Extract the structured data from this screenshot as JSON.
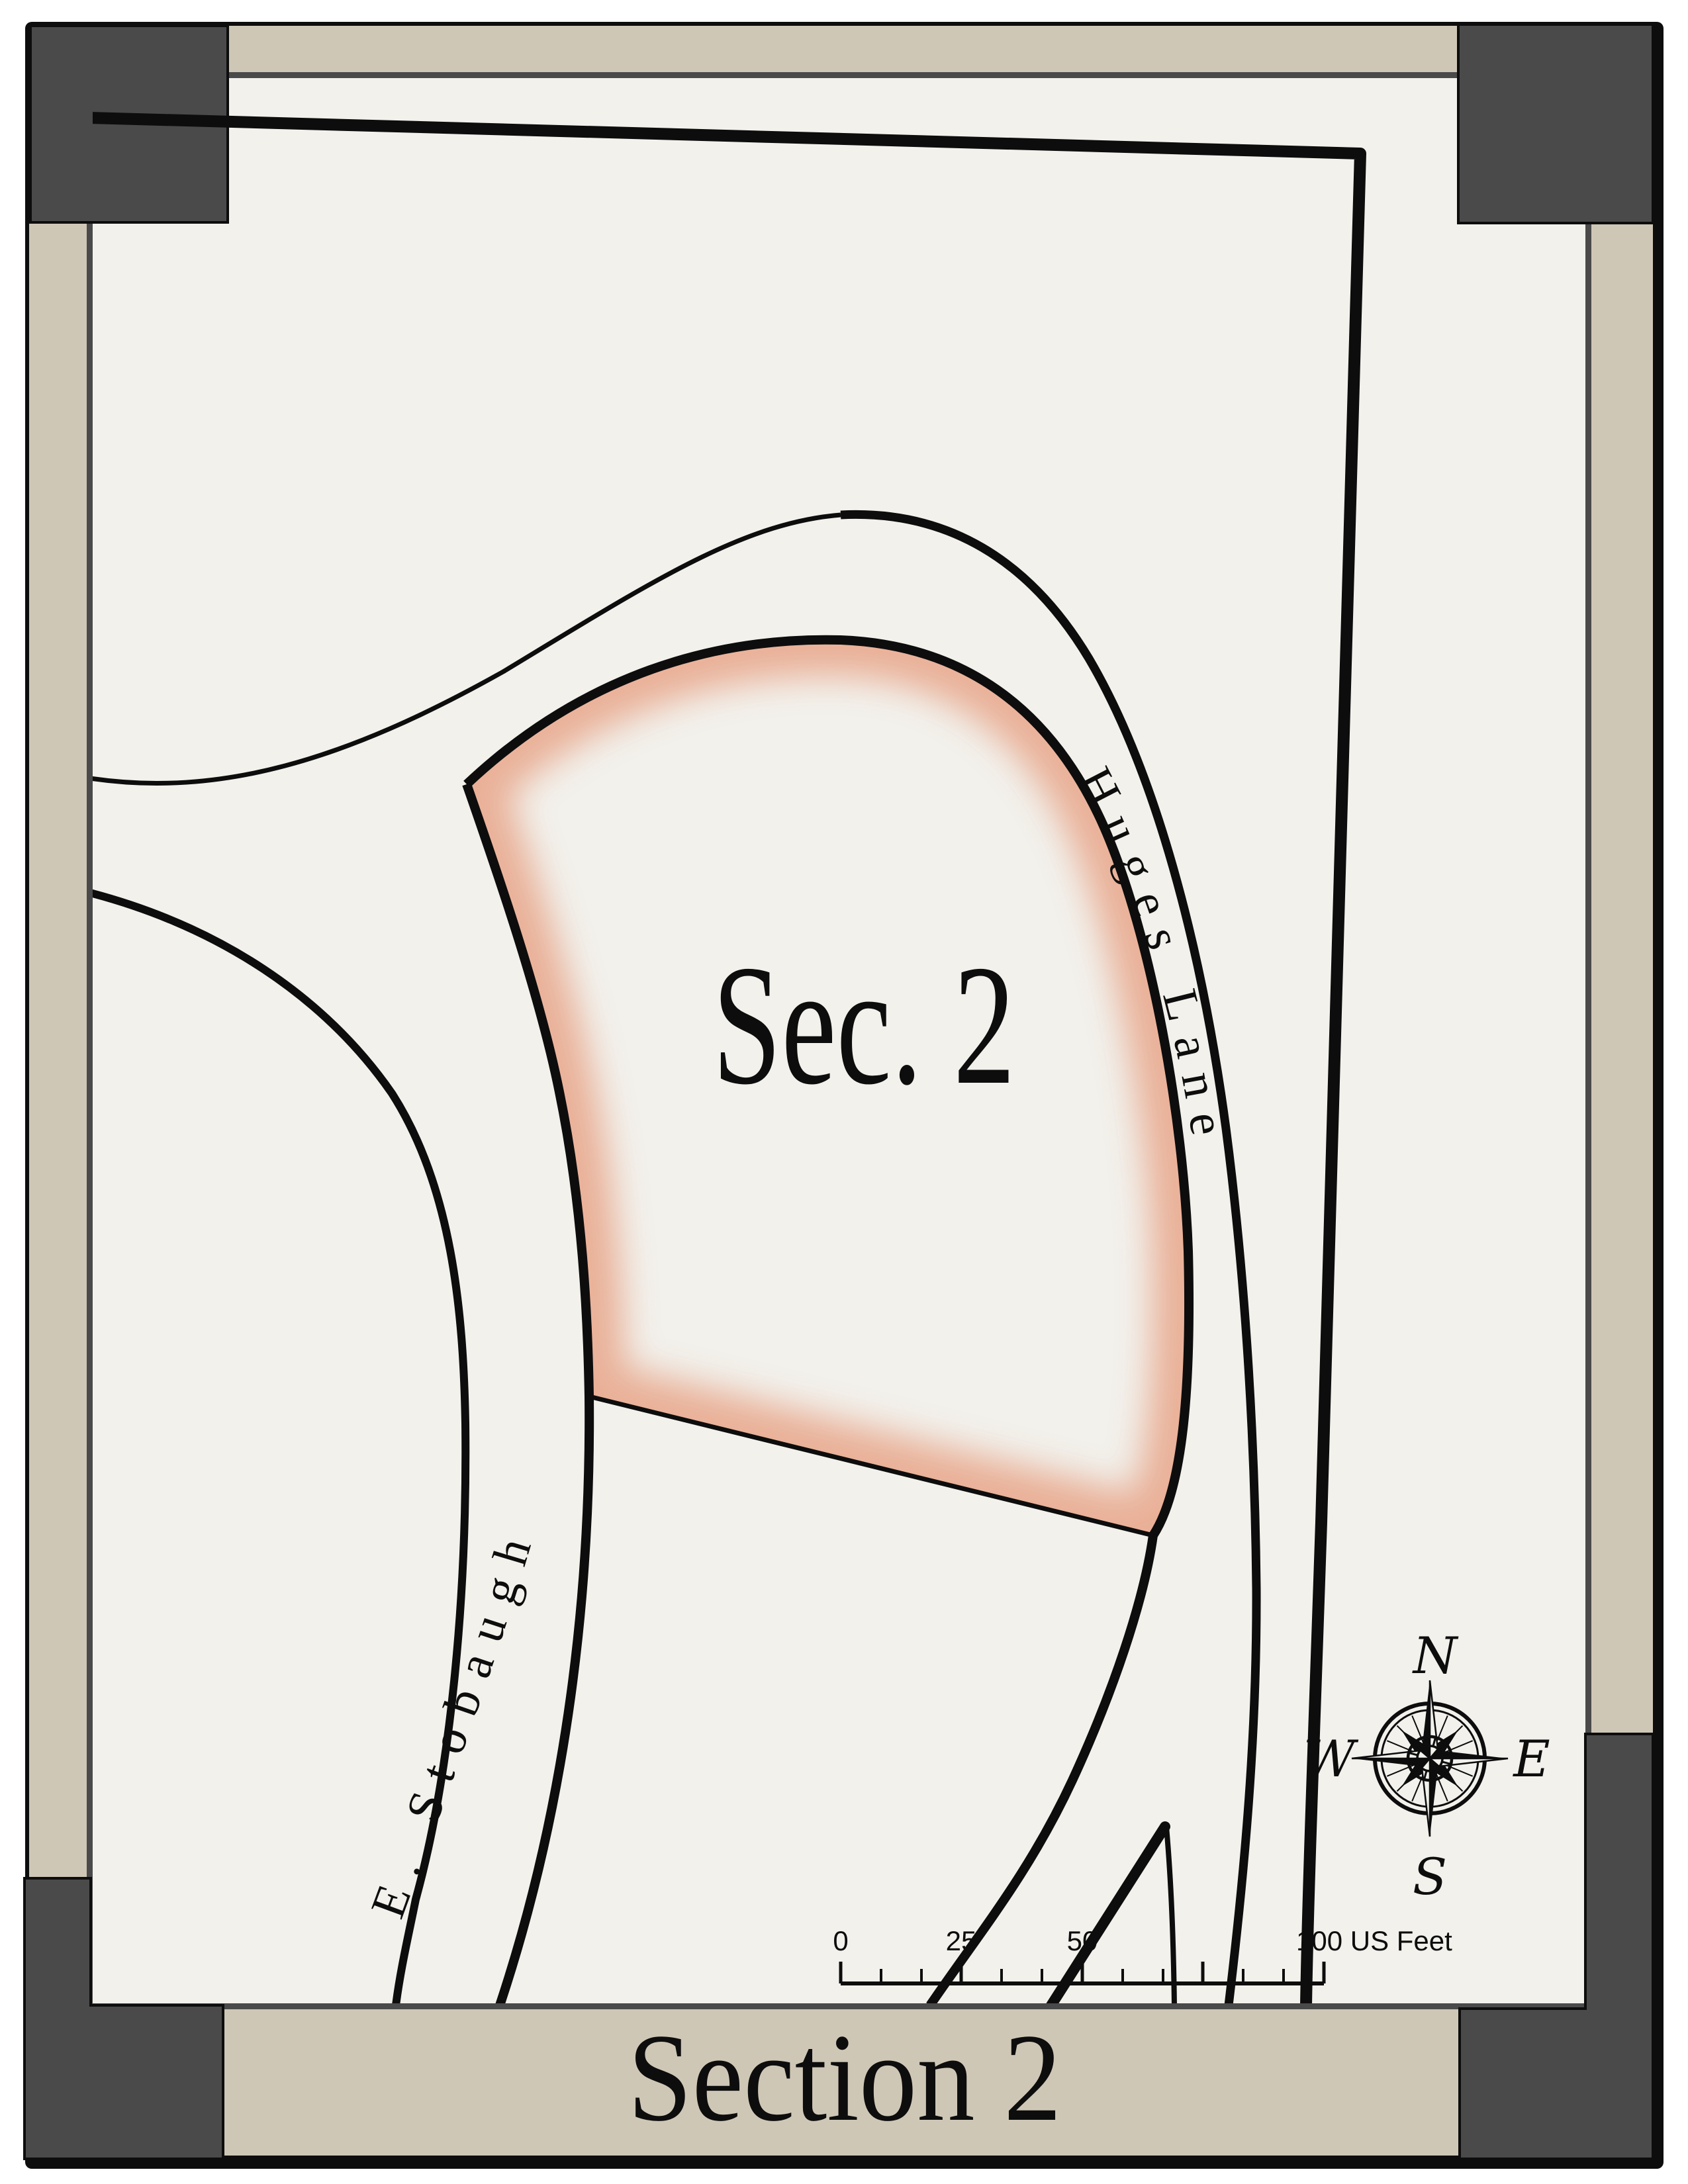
{
  "map": {
    "parcel_label": "Sec. 2",
    "streets": [
      {
        "name": "Huges Lane"
      },
      {
        "name": "E. Stobaugh"
      }
    ]
  },
  "scale_bar": {
    "labels": [
      "0",
      "25",
      "50"
    ],
    "end_label": "100 US Feet"
  },
  "compass": {
    "north": "N",
    "east": "E",
    "south": "S",
    "west": "W"
  },
  "footer": {
    "title": "Section 2"
  },
  "colors": {
    "paper": "#f2f1ec",
    "band_tan": "#cfc7b6",
    "frame_dark": "#4a4a4a",
    "ink": "#0d0d0d",
    "parcel_glow": "#e8a98e"
  }
}
